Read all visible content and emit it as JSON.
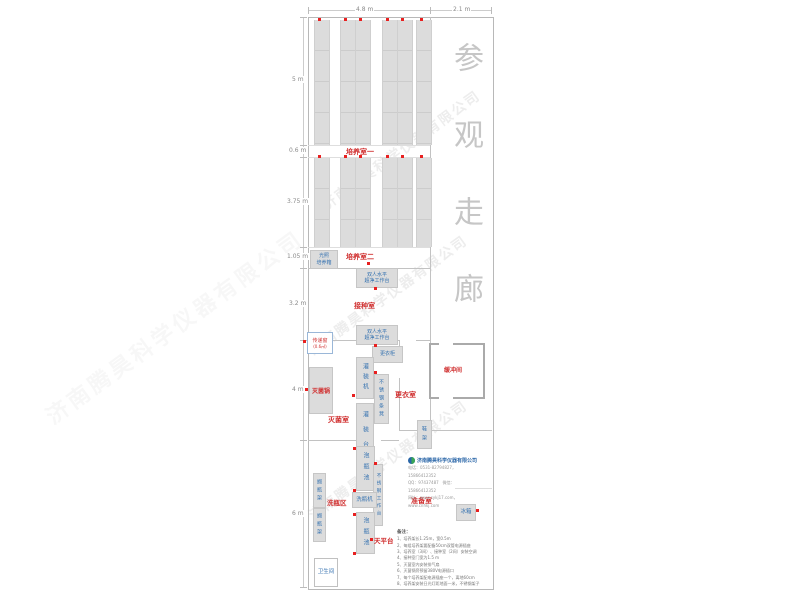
{
  "watermark": "济南腾昊科学仪器有限公司",
  "corridor": {
    "label": "参观走廊"
  },
  "dimensions": {
    "top_main": "4.8 m",
    "top_corridor": "2.1 m",
    "left": [
      "5 m",
      "0.6 m",
      "3.75 m",
      "1.05 m",
      "3.2 m",
      "4 m",
      "6 m"
    ]
  },
  "rooms": {
    "culture1": "培养室一",
    "culture2": "培养室二",
    "inoculation": "接种室",
    "sterilization": "灭菌室",
    "changing": "更衣室",
    "buffer": "缓冲间",
    "washing_area": "洗瓶区",
    "prep": "准备室",
    "toilet": "卫生间"
  },
  "equipment": {
    "light_incubator": {
      "line1": "光照",
      "line2": "培养箱"
    },
    "clean_bench": {
      "line1": "双人水平",
      "line2": "超净工作台"
    },
    "pass_window": {
      "name": "传递窗",
      "size": "(0.6㎡)"
    },
    "wardrobe": "更衣柜",
    "filling_machine": "灌装机",
    "autoclave": "灭菌锅",
    "ss_bench": "不锈钢条凳",
    "filling_table": "灌装台",
    "shoe_rack": "鞋架",
    "soak_pool": "泡瓶池",
    "ss_worktable": "不锈钢工作台",
    "bottle_washer": "洗瓶机",
    "balance_table": "天平台",
    "bottle_rack": "搁瓶架",
    "fridge": "冰箱"
  },
  "company": {
    "name": "济南腾昊科学仪器有限公司",
    "phone_line": "电话：0531-82794827，15866412352",
    "qq_line": "QQ：97437487　微信：15866412352",
    "web_line": "网址：www.sykj17.com，www.cnhkj.com"
  },
  "notes": {
    "title": "备注：",
    "items": [
      "1、培养架长1.25m，宽0.5m",
      "2、每组培养架要配备50cm双管电源插座",
      "3、培养室（3间）、接种室（2间）安装空调",
      "4、接种室门宽为1.5 m",
      "5、灭菌室内安装排气扇",
      "6、灭菌锅旁预留380V电源插口",
      "7、每个培养架配电源插座一个，离地60cm",
      "8、培养架安装日光灯距地面一米，不锈钢架子"
    ]
  }
}
